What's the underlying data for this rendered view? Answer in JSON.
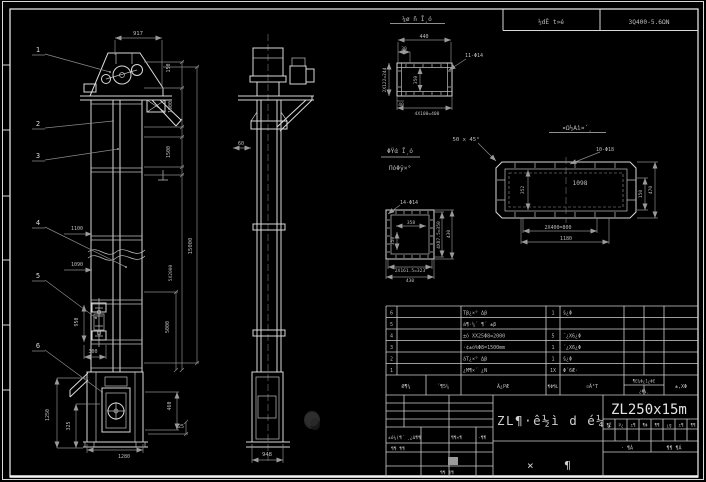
{
  "colors": {
    "background": "#000000",
    "line": "#d9d9d9",
    "dim_line": "#8a8a8a",
    "text": "#bdbdbd",
    "highlight_cell": "#9a9a9a"
  },
  "header": {
    "left_box": "½dÊ t»é",
    "right_box": "3Q400-5.6ΩN"
  },
  "front_view": {
    "balloons": [
      "1",
      "2",
      "3",
      "4",
      "5",
      "6"
    ],
    "dims": {
      "top_width": "917",
      "head_top": "150",
      "head": "1900",
      "upper": "1500",
      "total_height": "15000",
      "sections": "5X2000",
      "mid": "5000",
      "inlet_a": "1100",
      "inlet_b": "1090",
      "takeup_stroke": "950",
      "takeup_w": "300",
      "boot_height": "1250",
      "boot_mid": "325",
      "boot_width": "1280",
      "boot_right": "460",
      "base": "25"
    }
  },
  "side_view": {
    "dims": {
      "upper": "60",
      "boot_width": "948"
    }
  },
  "flange_a": {
    "title": "¼ø ñ Ī¸ó",
    "dims": {
      "width": "440",
      "offset": "30",
      "holes": "11-Φ14",
      "left": "2X122=244",
      "inner": "350",
      "edge": "40",
      "bottom": "4X100=400"
    }
  },
  "flange_b": {
    "dims": {
      "holes": "14-Φ14",
      "inner_width": "358",
      "inner_height": "350",
      "right_a": "4X87.5=350",
      "right_b": "430",
      "bottom_a": "2X161.5=323",
      "bottom_b": "430"
    }
  },
  "duct_view": {
    "title": "¤Ω½Αì¤´¸",
    "dims": {
      "chamfer": "50 x 45°",
      "holes": "10-Φ18",
      "length": "1098",
      "left": "352",
      "right_a": "150",
      "right_b": "470",
      "bottom_a": "2X400=800",
      "bottom_b": "1180"
    }
  },
  "note": {
    "line1": "ΦΫά Ī¸ó",
    "line2": "ΠόΦÿ×°"
  },
  "parts_table": {
    "headers": {
      "no": "Ø¶¼",
      "code": "´¶5¼",
      "name": "Ã¿ΡÆ",
      "qty": "¶Φ¶L",
      "material": "¤Ã³T",
      "weight_top": "¶Ε¼Φ¿1¿ΦΕ",
      "weight_bottom": "¿Φ¼¸",
      "remark": "±,XΦ"
    },
    "rows": [
      {
        "no": "6",
        "name": "Τβ¿×° Δβ",
        "qty": "1",
        "material": "§¿Φ"
      },
      {
        "no": "5",
        "name": "á¶·¼´ ¶´ ±β",
        "qty": "",
        "material": ""
      },
      {
        "no": "4",
        "name": "±ó XX25Φ8=2000",
        "qty": "5",
        "material": "´¿Χ6¿Φ"
      },
      {
        "no": "3",
        "name": "·¢±ó%Φ8=1500mm",
        "qty": "1",
        "material": "´¿Χ6¿Φ"
      },
      {
        "no": "2",
        "name": "áΤ¿×° Δβ",
        "qty": "1",
        "material": "§¿Φ"
      },
      {
        "no": "1",
        "name": "¿Μ¶×´ ¿Ν",
        "qty": "1X",
        "material": "Φ´6Æ·"
      }
    ]
  },
  "title_block": {
    "drawing_title": "ZL¶·ê½ì d é¼¸",
    "model": "ZL250x15m",
    "subtitle": "× ¶",
    "sig_cells": [
      "±ó¼(¶´",
      "¸¿Δ¶¶",
      "¶¶×¶",
      "·¶¶"
    ],
    "sig_row2": "¶¶ ¶¶",
    "sig_row3": "¶¶ ¶¶",
    "rev_cells": [
      "¶Ê",
      "Ρ¿",
      "±¶",
      "¶Φ",
      "¶¶",
      "¿g",
      "±¶",
      "¶¶"
    ],
    "sheet_left": "· ¶Á",
    "sheet_right": "¶¶ ¶Á"
  }
}
